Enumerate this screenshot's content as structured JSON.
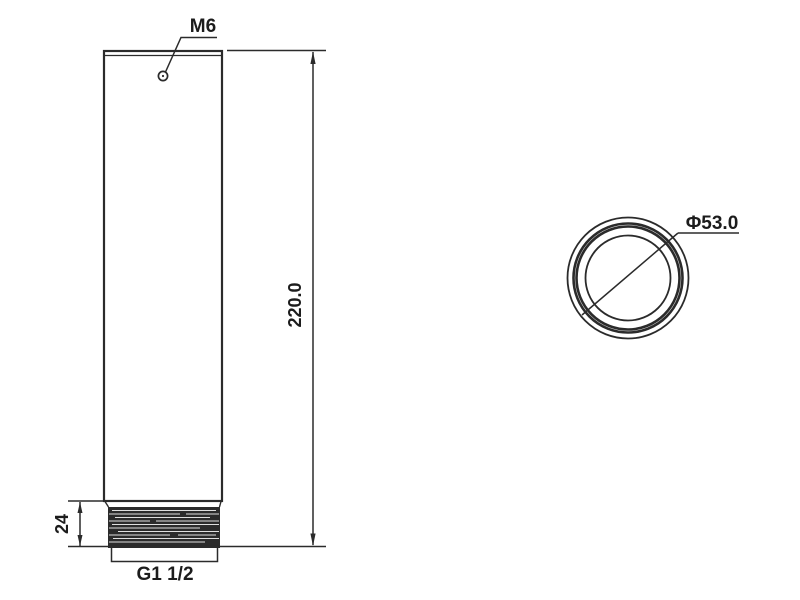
{
  "drawing": {
    "type": "technical-drawing",
    "colors": {
      "line": "#2b2b2b",
      "text": "#1c1c1c",
      "background": "#ffffff"
    },
    "front_view": {
      "labels": {
        "top_hole_thread": "M6",
        "overall_height_dim": "220.0",
        "thread_length_dim": "24",
        "pipe_thread_spec": "G1 1/2"
      }
    },
    "end_view": {
      "labels": {
        "outer_diameter_dim": "Φ53.0"
      }
    }
  }
}
